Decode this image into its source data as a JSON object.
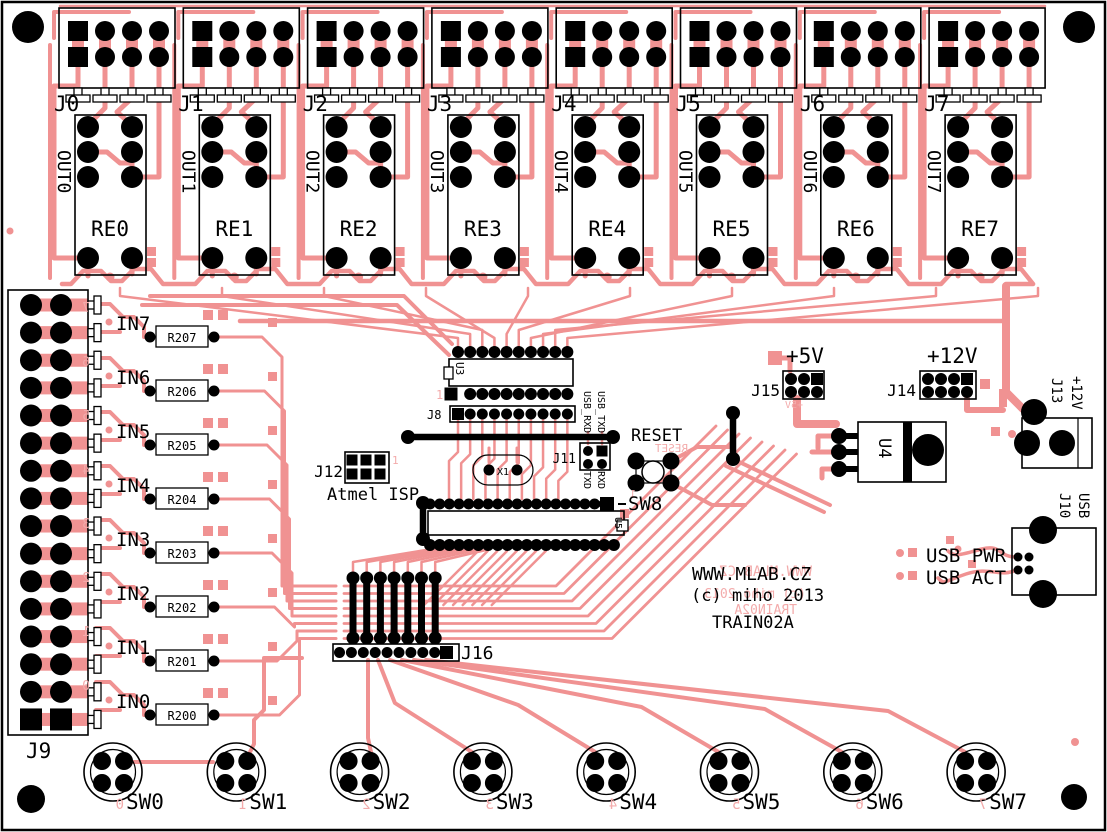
{
  "board": {
    "site": "WWW.MLAB.CZ",
    "copyright": "(c) miho 2013",
    "name": "TRAIN02A"
  },
  "colors": {
    "copper": "#F09292",
    "silk": "#000000",
    "mirror_silk": "#F3ABAB",
    "background": "#FFFFFF"
  },
  "relay_modules": [
    {
      "connector": "J0",
      "relay": "RE0",
      "output": "OUT0"
    },
    {
      "connector": "J1",
      "relay": "RE1",
      "output": "OUT1"
    },
    {
      "connector": "J2",
      "relay": "RE2",
      "output": "OUT2"
    },
    {
      "connector": "J3",
      "relay": "RE3",
      "output": "OUT3"
    },
    {
      "connector": "J4",
      "relay": "RE4",
      "output": "OUT4"
    },
    {
      "connector": "J5",
      "relay": "RE5",
      "output": "OUT5"
    },
    {
      "connector": "J6",
      "relay": "RE6",
      "output": "OUT6"
    },
    {
      "connector": "J7",
      "relay": "RE7",
      "output": "OUT7"
    }
  ],
  "inputs": {
    "connector": "J9",
    "rows": [
      {
        "label": "IN7",
        "resistor": "R207",
        "mirror_digit": "7"
      },
      {
        "label": "IN6",
        "resistor": "R206",
        "mirror_digit": "6"
      },
      {
        "label": "IN5",
        "resistor": "R205",
        "mirror_digit": "5"
      },
      {
        "label": "IN4",
        "resistor": "R204",
        "mirror_digit": "4"
      },
      {
        "label": "IN3",
        "resistor": "R203",
        "mirror_digit": "3"
      },
      {
        "label": "IN2",
        "resistor": "R202",
        "mirror_digit": "2"
      },
      {
        "label": "IN1",
        "resistor": "R201",
        "mirror_digit": "1"
      },
      {
        "label": "IN0",
        "resistor": "R200",
        "mirror_digit": "0"
      }
    ]
  },
  "buttons": [
    {
      "label": "SW0",
      "mirror_digit": "0"
    },
    {
      "label": "SW1",
      "mirror_digit": "1"
    },
    {
      "label": "SW2",
      "mirror_digit": "2"
    },
    {
      "label": "SW3",
      "mirror_digit": "3"
    },
    {
      "label": "SW4",
      "mirror_digit": "4"
    },
    {
      "label": "SW5",
      "mirror_digit": "5"
    },
    {
      "label": "SW6",
      "mirror_digit": "6"
    },
    {
      "label": "SW7",
      "mirror_digit": "7"
    }
  ],
  "center": {
    "u3": "U3",
    "u3_pin1": "1",
    "j8": "J8",
    "isp_connector": "J12",
    "isp_caption": "Atmel ISP",
    "isp_pin1": "1",
    "crystal": "X1",
    "serial_header": "J11",
    "serial_top": [
      "USB_RXD",
      "USB_TXD"
    ],
    "serial_bottom": [
      "TXD",
      "RXD"
    ],
    "reset_label": "RESET",
    "reset_mirror": "RESET",
    "reset_pin1": "1",
    "reset_button": "SW8",
    "mcu": "U5",
    "bus_header": "J16"
  },
  "power": {
    "v5_label": "+5V",
    "v5_header": "J15",
    "v5_mirror": "+5V",
    "v12_label": "+12V",
    "v12_header": "J14",
    "regulator": "U4",
    "jack_label": "J13",
    "jack_caption": "+12V"
  },
  "usb": {
    "connector": "J10",
    "caption": "USB",
    "power_led": "USB PWR",
    "activity_led": "USB ACT"
  }
}
